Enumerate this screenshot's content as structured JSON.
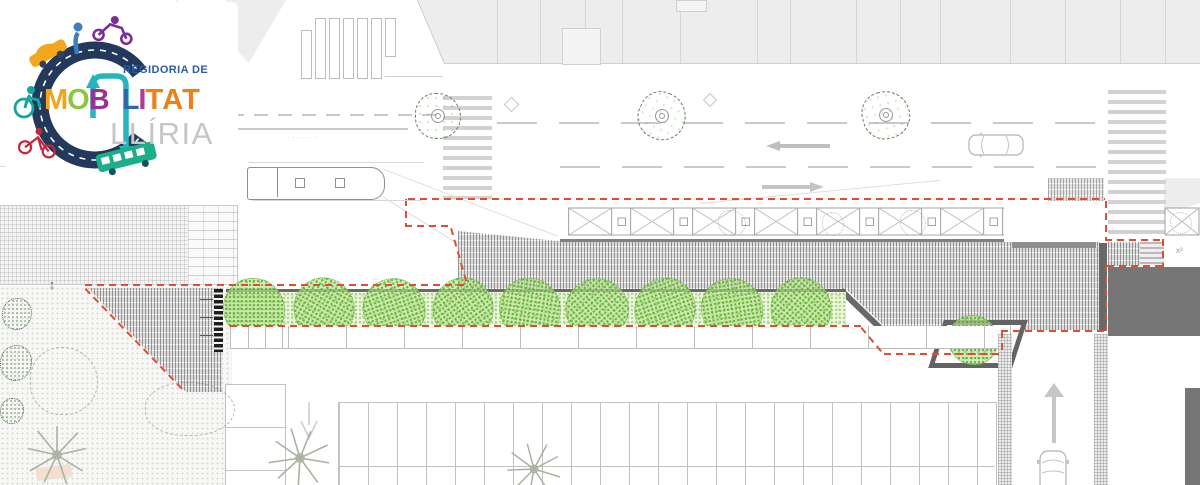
{
  "logo": {
    "dept_line": "REGIDORIA DE",
    "word_letters": [
      {
        "ch": "M",
        "color": "#f2a41d"
      },
      {
        "ch": "O",
        "color": "#8ec63f"
      },
      {
        "ch": "B",
        "color": "#9c2f92"
      },
      {
        "ch": "L",
        "color": "#2f66ad"
      },
      {
        "ch": "I",
        "color": "#b03a96"
      },
      {
        "ch": "T",
        "color": "#ec8117"
      },
      {
        "ch": "A",
        "color": "#ec8117"
      },
      {
        "ch": "T",
        "color": "#ec8117"
      }
    ],
    "city": "LLÍRIA",
    "brand_colors": {
      "road_navy": "#22395c",
      "arrow_teal": "#28b4bd",
      "bus_green": "#1cae89",
      "car_yellow": "#f2a71f",
      "moto_purple": "#7b2e93",
      "bike_red": "#c3273a",
      "person_blue": "#3f7fc1",
      "wheelchair_teal": "#14a5a0"
    }
  },
  "drawing": {
    "boundary_color": "#dc5030",
    "bus_stop_micro_label": "·· ··· · ····",
    "survey_marker": "x²",
    "row_tree_count": 9
  }
}
